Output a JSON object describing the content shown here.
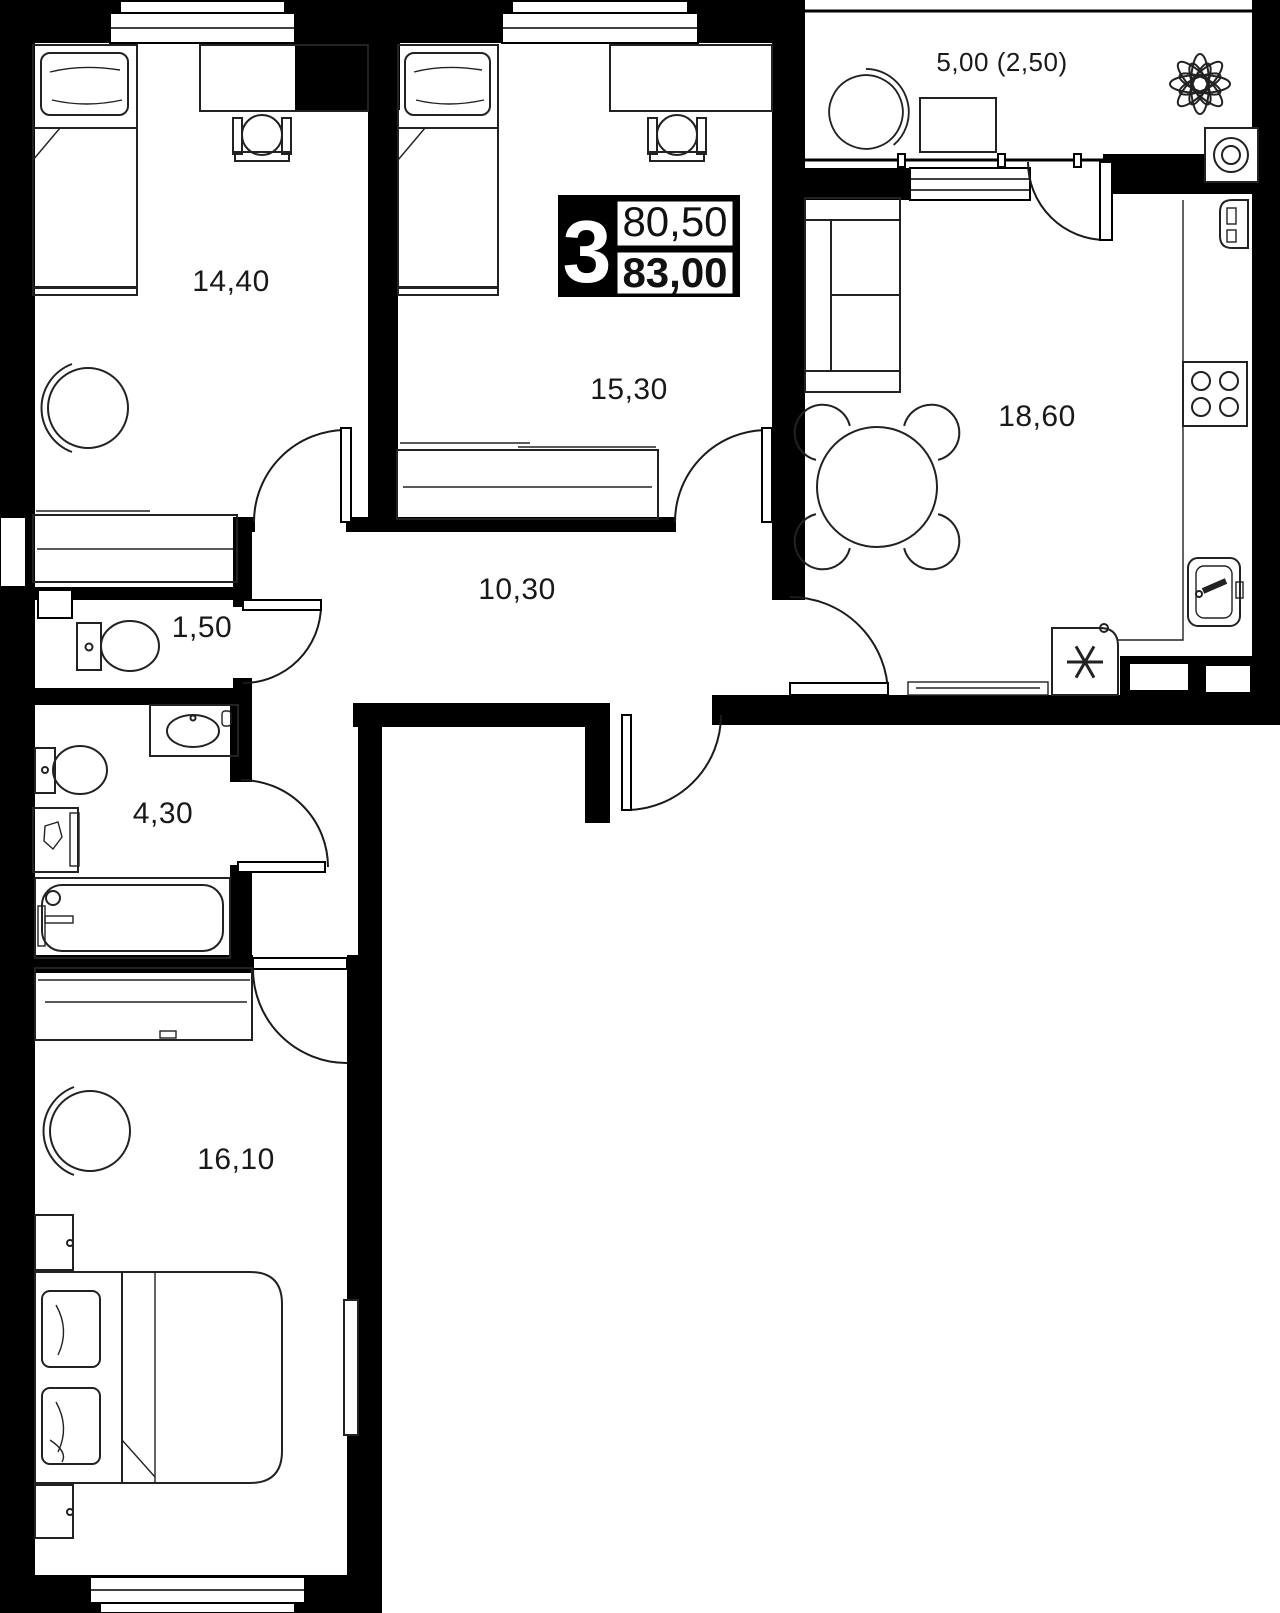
{
  "badge": {
    "rooms_count": "3",
    "area_living": "80,50",
    "area_total": "83,00"
  },
  "rooms": [
    {
      "id": "bedroom-top-left",
      "area": "14,40"
    },
    {
      "id": "bedroom-top-middle",
      "area": "15,30"
    },
    {
      "id": "kitchen-living",
      "area": "18,60"
    },
    {
      "id": "balcony",
      "area": "5,00 (2,50)"
    },
    {
      "id": "hallway",
      "area": "10,30"
    },
    {
      "id": "wc",
      "area": "1,50"
    },
    {
      "id": "bathroom",
      "area": "4,30"
    },
    {
      "id": "bedroom-bottom",
      "area": "16,10"
    }
  ],
  "colors": {
    "wall": "#000000",
    "background": "#ffffff",
    "line": "#222222"
  }
}
